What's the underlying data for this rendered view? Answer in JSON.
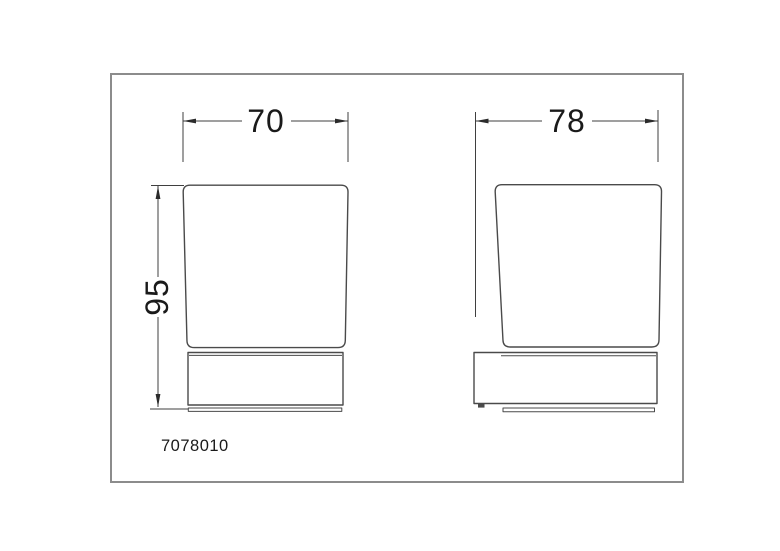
{
  "drawing": {
    "part_number": "7078010",
    "dimensions": {
      "glass_width": "70",
      "holder_width": "78",
      "height": "95"
    },
    "colors": {
      "object_line": "#4a4a4a",
      "dimension_line": "#3f3f3f",
      "arrow": "#2b2b2b",
      "text": "#1a1a1a",
      "frame": "#8c8c8c",
      "background": "#ffffff"
    }
  }
}
